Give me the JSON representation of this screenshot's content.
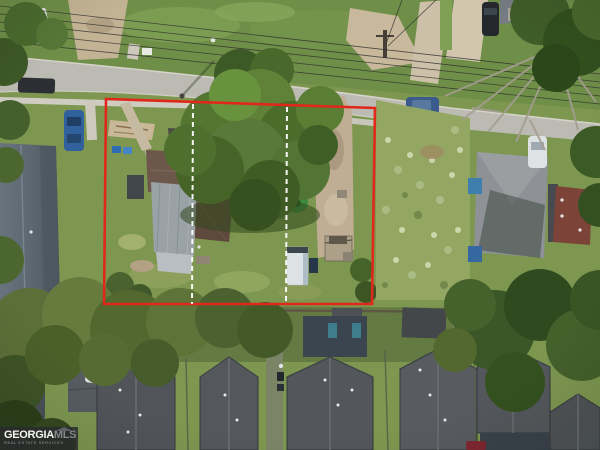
{
  "image": {
    "kind": "aerial-drone-photo",
    "subject": "residential-lot-outlined-in-red-with-two-dashed-lot-division-lines"
  },
  "watermark": {
    "brand_primary": "GEORGIA",
    "brand_secondary": "MLS",
    "tagline": "REAL ESTATE SERVICES"
  },
  "overlay": {
    "boundary_color": "#e0281a",
    "boundary_width": 2.6,
    "boundary_corners": [
      [
        106,
        99
      ],
      [
        375,
        108
      ],
      [
        372,
        304
      ],
      [
        104,
        304
      ]
    ],
    "divider_color": "#ffffff",
    "divider_dash": "5 4",
    "dividers": [
      {
        "x1": 193,
        "y1": 104,
        "x2": 192,
        "y2": 304
      },
      {
        "x1": 287,
        "y1": 107,
        "x2": 286,
        "y2": 304
      }
    ]
  },
  "palette": {
    "grass": "#7d9750",
    "road": "#bcbbb3",
    "dirt_driveway": "#bfae93",
    "subject_roof_brown": "#6d564a",
    "subject_roof_gray": "#9aa2a7",
    "new_house_roof": "#53575b",
    "tree_canopy": "#4c6c2c",
    "watermark_bar": "#2a2a2c"
  }
}
